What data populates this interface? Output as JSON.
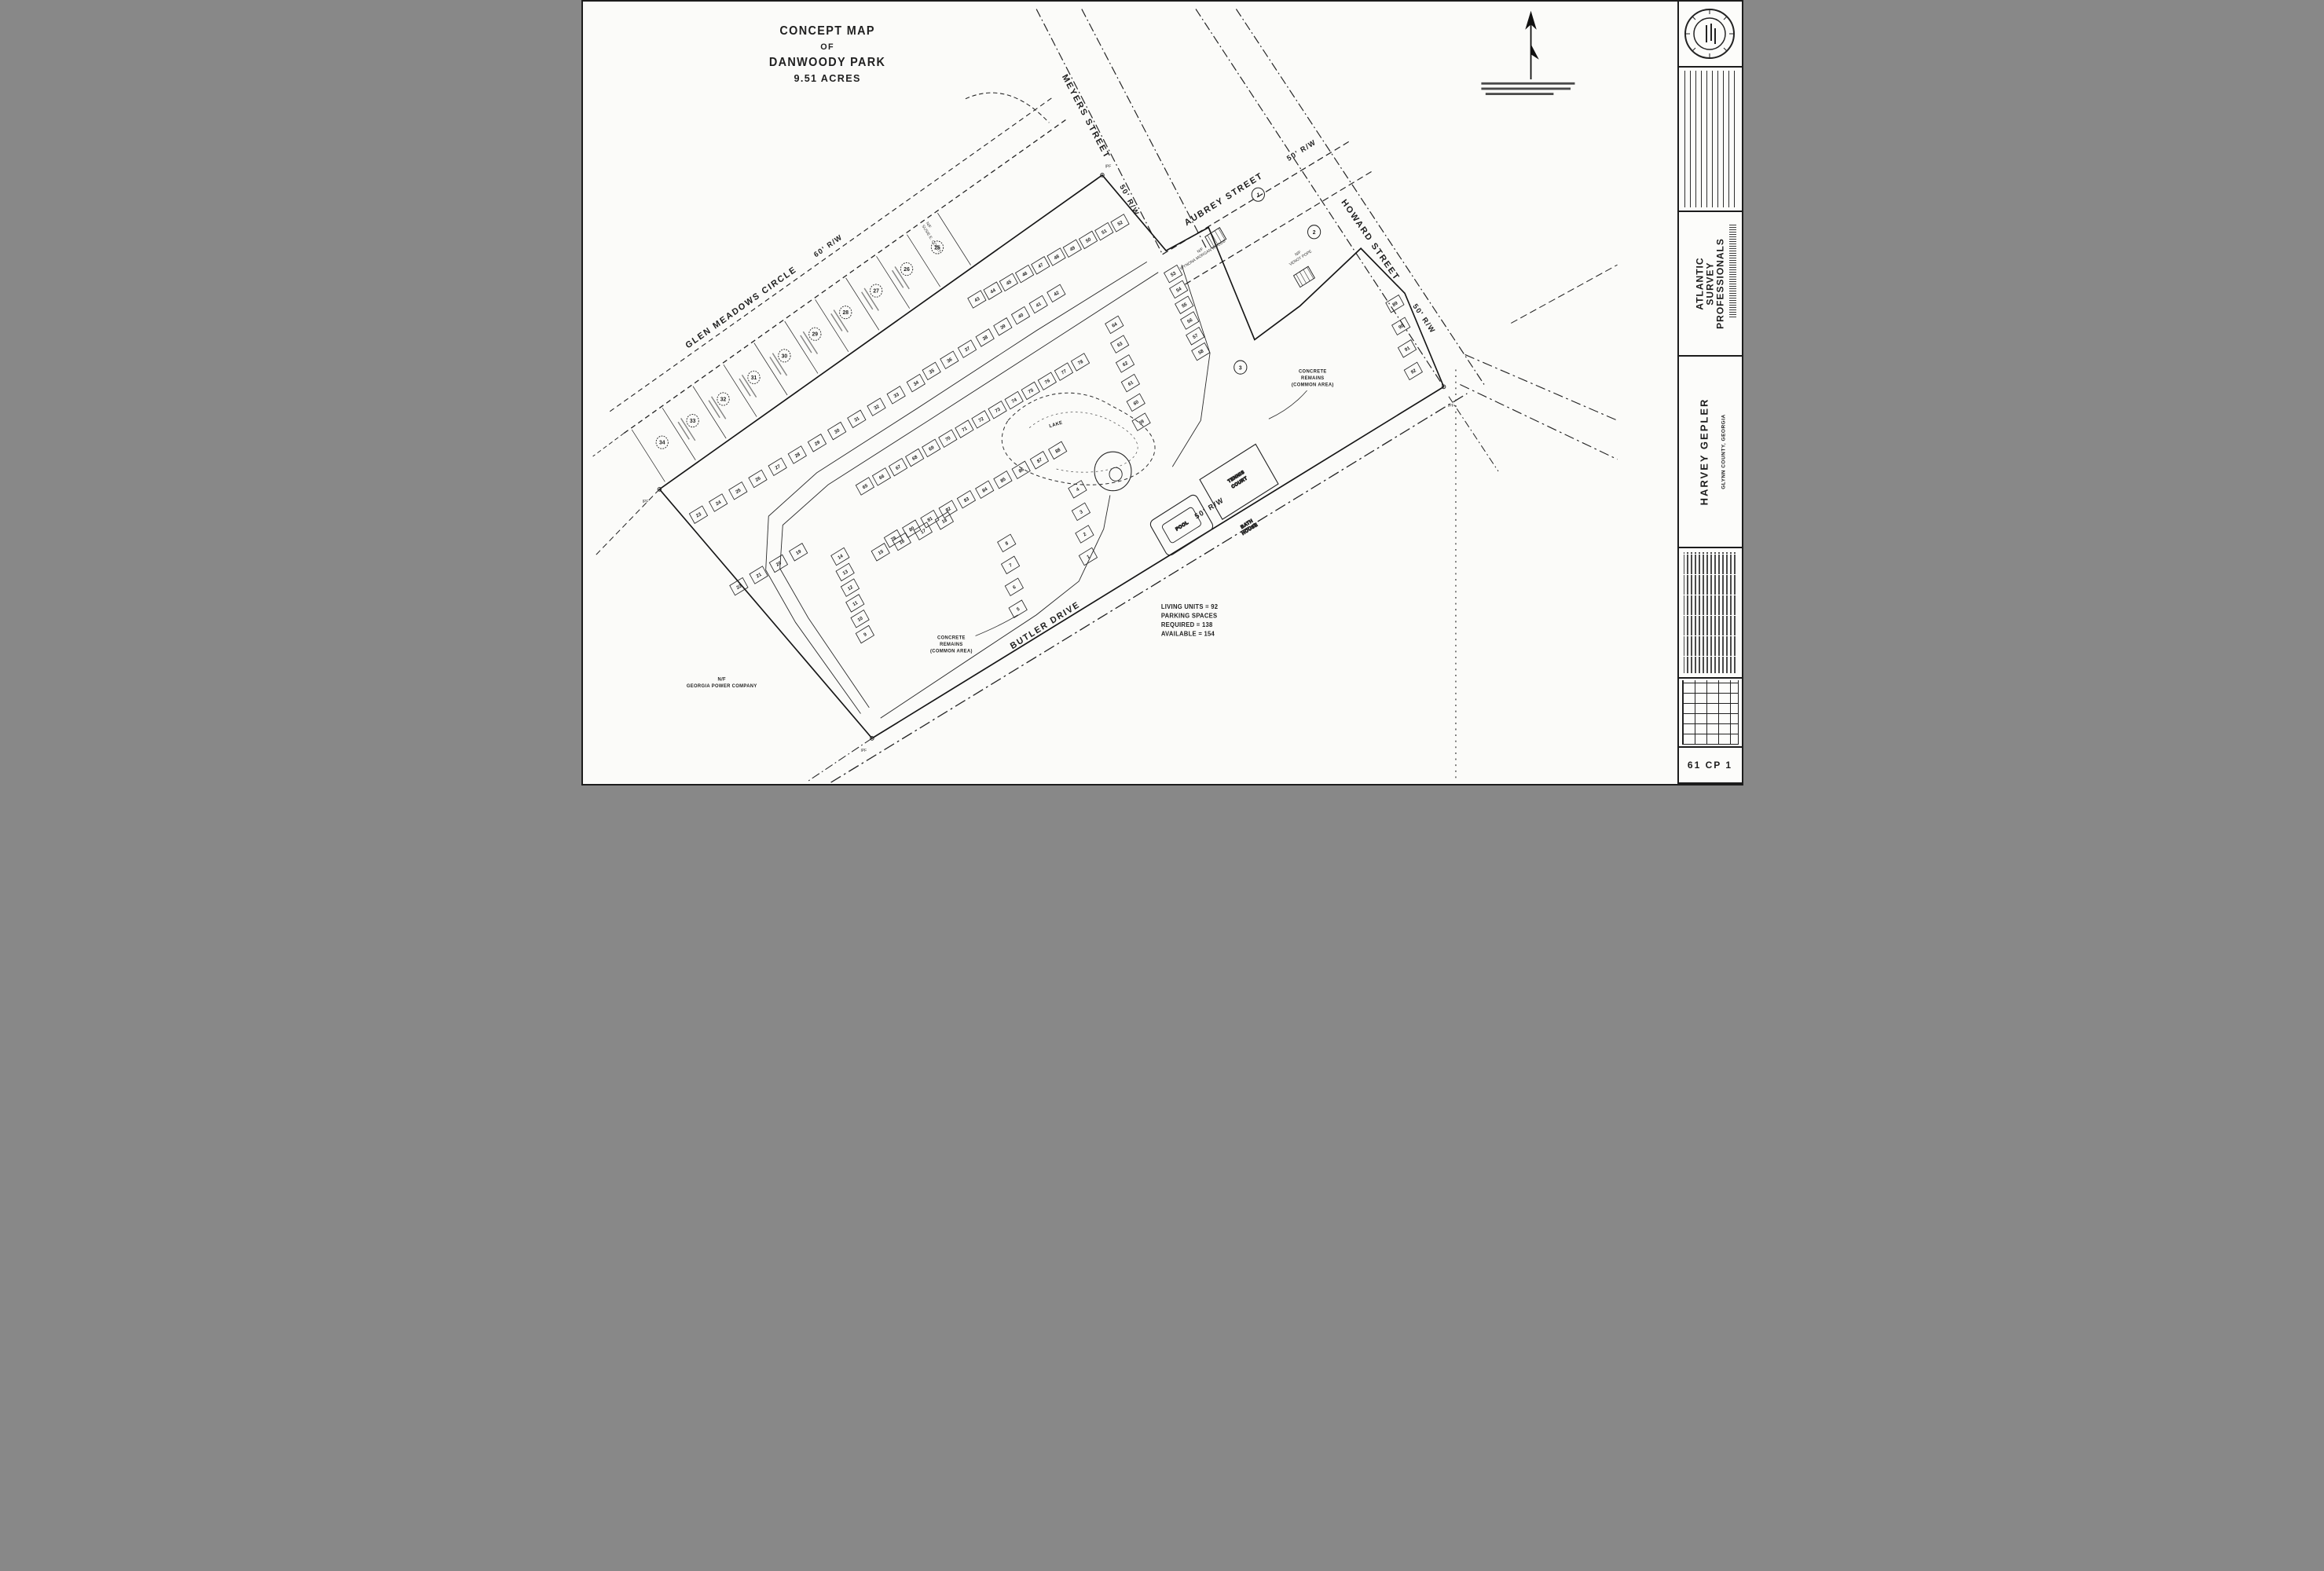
{
  "title_box": {
    "lines": [
      "CONCEPT MAP",
      "OF",
      "DANWOODY PARK",
      "9.51 ACRES"
    ]
  },
  "streets": {
    "glen_meadows": {
      "label": "GLEN MEADOWS CIRCLE",
      "row": "60' R/W"
    },
    "meyers": {
      "label": "MEYERS STREET",
      "row": "50' R/W"
    },
    "aubrey": {
      "label": "AUBREY STREET",
      "row": "50' R/W"
    },
    "howard": {
      "label": "HOWARD STREET",
      "row": "50' R/W"
    },
    "butler": {
      "label": "BUTLER DRIVE",
      "row": "50' R/W"
    }
  },
  "site_labels": {
    "lake": "LAKE",
    "pool": "POOL",
    "bath_house_l1": "BATH",
    "bath_house_l2": "HOUSE",
    "tennis_l1": "TENNIS",
    "tennis_l2": "COURT",
    "concrete_l1": "CONCRETE",
    "concrete_l2": "REMAINS",
    "concrete_l3": "(COMMON AREA)"
  },
  "adjoiners": {
    "nf": "N/F",
    "georgia_power": "GEORGIA POWER COMPANY",
    "wynona": "WYNONA MORGAN WOODS",
    "venoy": "VENOY POPE",
    "susie": "SUSIE E. COPET",
    "aubrey_lot_1": "1",
    "aubrey_lot_2": "2",
    "aubrey_lot_3": "3"
  },
  "stats": {
    "lines": [
      "LIVING UNITS = 92",
      "PARKING SPACES",
      "REQUIRED = 138",
      "AVAILABLE = 154"
    ]
  },
  "markers": {
    "pipe": "IPF"
  },
  "glen_meadows_lots": [
    "34",
    "33",
    "32",
    "31",
    "30",
    "29",
    "28",
    "27",
    "26",
    "25"
  ],
  "unit_groups": {
    "band_a": [
      "23",
      "24",
      "25",
      "26",
      "27",
      "28",
      "29",
      "30",
      "31",
      "32",
      "33",
      "34"
    ],
    "band_b": [
      "35",
      "36",
      "37",
      "38",
      "39",
      "40",
      "41",
      "42"
    ],
    "band_c": [
      "43",
      "44",
      "45",
      "46",
      "47",
      "48",
      "49",
      "50",
      "51",
      "52"
    ],
    "col_d": [
      "53",
      "54",
      "55",
      "56",
      "57",
      "58"
    ],
    "col_e": [
      "64",
      "63",
      "62",
      "61",
      "60",
      "59"
    ],
    "band_f": [
      "65",
      "66",
      "67",
      "68",
      "69",
      "70",
      "71",
      "72",
      "73",
      "74",
      "75",
      "76",
      "77",
      "78"
    ],
    "band_g": [
      "79",
      "80",
      "81",
      "82",
      "83",
      "84",
      "85",
      "86",
      "87",
      "88"
    ],
    "col_h": [
      "14",
      "13",
      "12",
      "11",
      "10",
      "9"
    ],
    "row_i": [
      "15",
      "16",
      "17",
      "18"
    ],
    "row_j": [
      "22",
      "21",
      "20",
      "19"
    ],
    "col_k": [
      "4",
      "3",
      "2",
      "1"
    ],
    "col_l": [
      "8",
      "7",
      "6",
      "5"
    ],
    "col_m": [
      "89",
      "90",
      "91",
      "92"
    ]
  },
  "title_block": {
    "firm_l1": "ATLANTIC",
    "firm_l2": "SURVEY",
    "firm_l3": "PROFESSIONALS",
    "client": "HARVEY GEPLER",
    "location": "GLYNN COUNTY, GEORGIA",
    "sheet_no": "61 CP 1"
  }
}
